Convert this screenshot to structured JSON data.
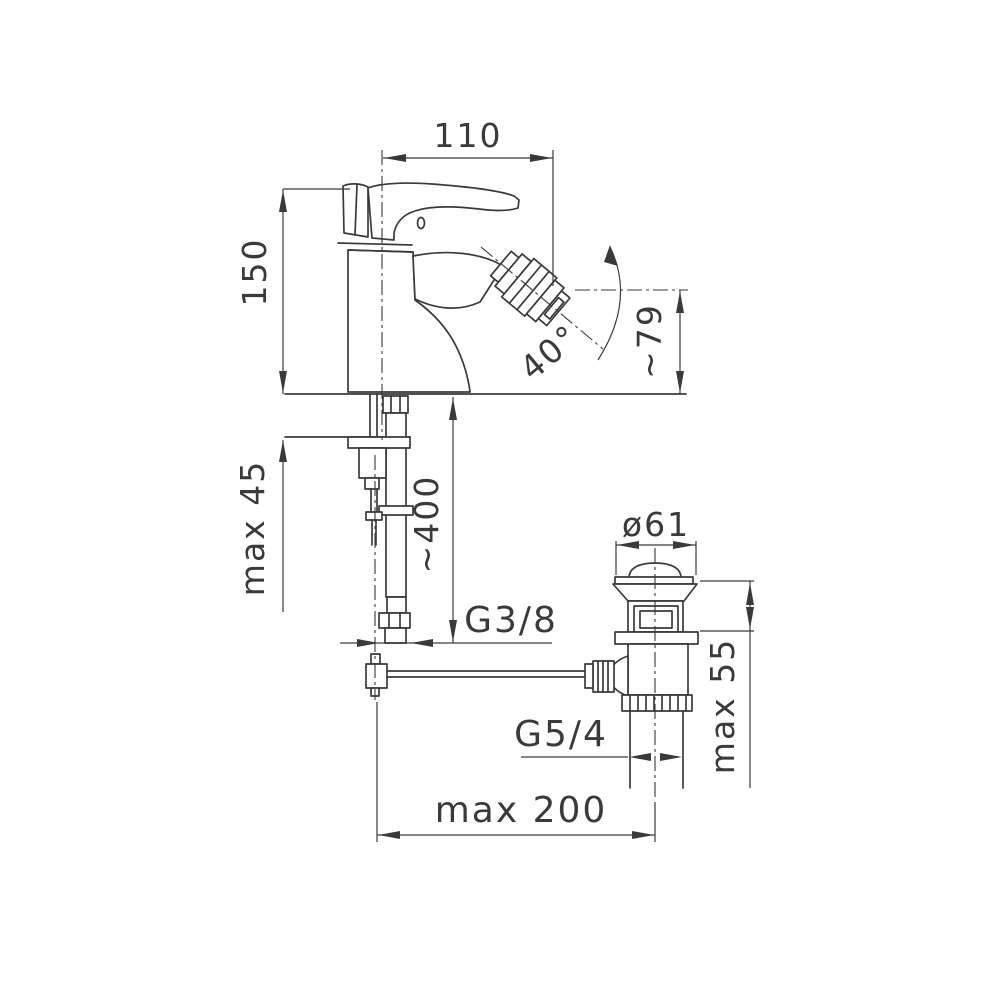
{
  "drawing": {
    "background": "#ffffff",
    "line_color": "#3a3a3a",
    "type": "technical-dimension-drawing",
    "subject": "single-lever bidet mixer with pop-up waste"
  },
  "dims": {
    "spout_reach": "110",
    "body_height": "150",
    "deck_thickness": "max 45",
    "hose_length": "~400",
    "hose_thread": "G3/8",
    "aerator_angle": "40°",
    "outlet_height": "~79",
    "plug_diameter": "ø61",
    "basin_clamp": "max 55",
    "drain_thread": "G5/4",
    "rod_reach": "max 200"
  }
}
